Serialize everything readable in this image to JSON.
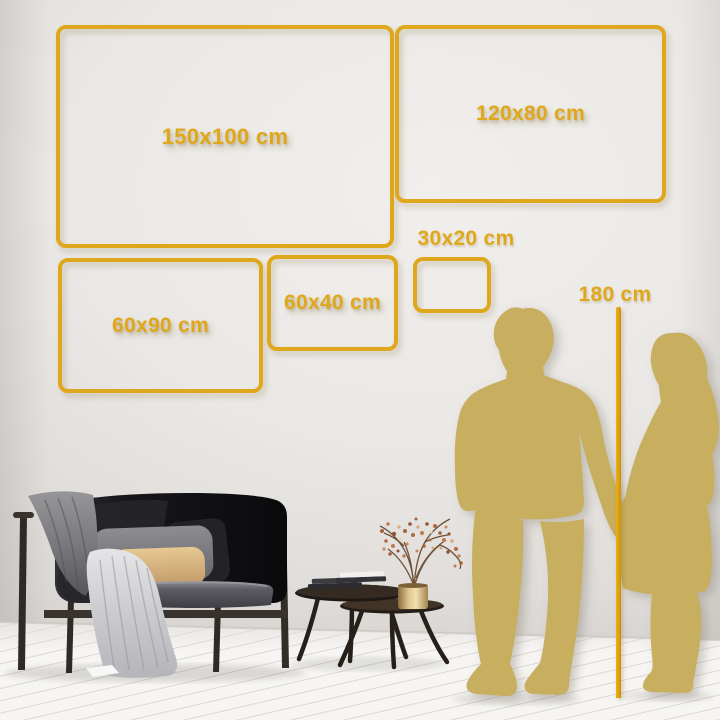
{
  "size_guide": {
    "frames": [
      {
        "id": "150x100",
        "label": "150x100 cm"
      },
      {
        "id": "120x80",
        "label": "120x80 cm"
      },
      {
        "id": "60x90",
        "label": "60x90 cm"
      },
      {
        "id": "60x40",
        "label": "60x40 cm"
      },
      {
        "id": "30x20",
        "label": "30x20 cm"
      }
    ],
    "height_reference": {
      "label": "180 cm"
    }
  },
  "colors": {
    "accent_gold": "#DFA71C",
    "silhouette_gold": "#C8AE5E",
    "pole_gold": "#DDA00E",
    "wall_light": "#EEECE9",
    "wall_dark": "#CCC9C6",
    "floor_white": "#F6F5F3",
    "sofa_black": "#141416",
    "blanket_gray": "#77777B",
    "drape_gray": "#C9C9CD",
    "pillow_tan": "#D7B384",
    "vase_brass": "#D9BD85",
    "blossom_rust": "#B06A45"
  },
  "decor": {
    "wall": "plain-plaster-wall",
    "floor": "white-wood-plank-floor",
    "items": [
      "black-fabric-sofa",
      "gray-arm-blanket",
      "light-gray-draped-blanket",
      "gray-pillow",
      "black-pillow",
      "tan-pillow",
      "round-nesting-coffee-tables",
      "stacked-books",
      "brass-vase",
      "dried-blossom-branches",
      "white-paper-on-floor"
    ]
  },
  "figures": {
    "items": [
      "man-silhouette",
      "woman-silhouette",
      "height-measuring-pole"
    ],
    "pose": "holding-hands"
  }
}
